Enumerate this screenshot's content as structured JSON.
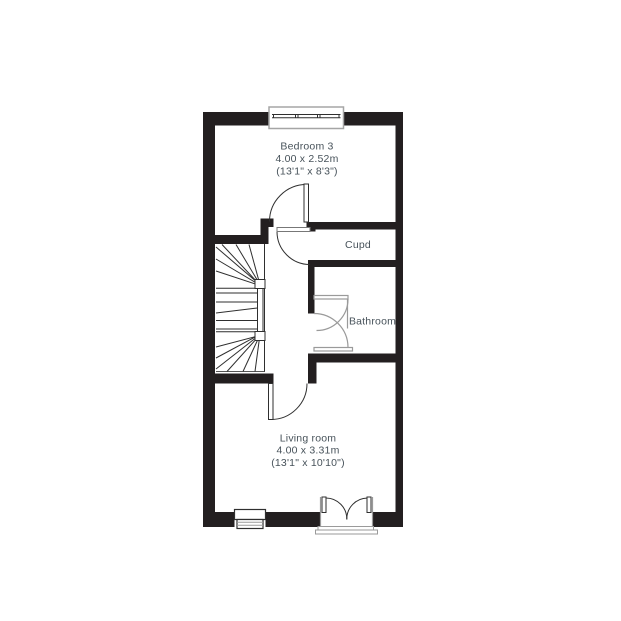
{
  "plan": {
    "type": "floorplan",
    "rooms": {
      "bedroom": {
        "label": "Bedroom 3",
        "size_m": "4.00 x 2.52m",
        "size_ft": "(13'1\" x 8'3\")"
      },
      "cupboard": {
        "label": "Cupd"
      },
      "bathroom": {
        "label": "Bathroom"
      },
      "living": {
        "label": "Living room",
        "size_m": "4.00 x 3.31m",
        "size_ft": "(13'1\" x 10'10\")"
      }
    },
    "features": [
      "stairs-with-winders",
      "top-window",
      "bottom-window",
      "french-doors",
      "bedroom-door",
      "cupboard-door",
      "bathroom-door",
      "living-room-door"
    ],
    "colors": {
      "wall": "#231f20",
      "line": "#2f2f2f",
      "fixture_gray": "#9a9a9a",
      "frame_gray": "#a5a5a5",
      "text": "#47525a",
      "background": "#ffffff"
    }
  }
}
